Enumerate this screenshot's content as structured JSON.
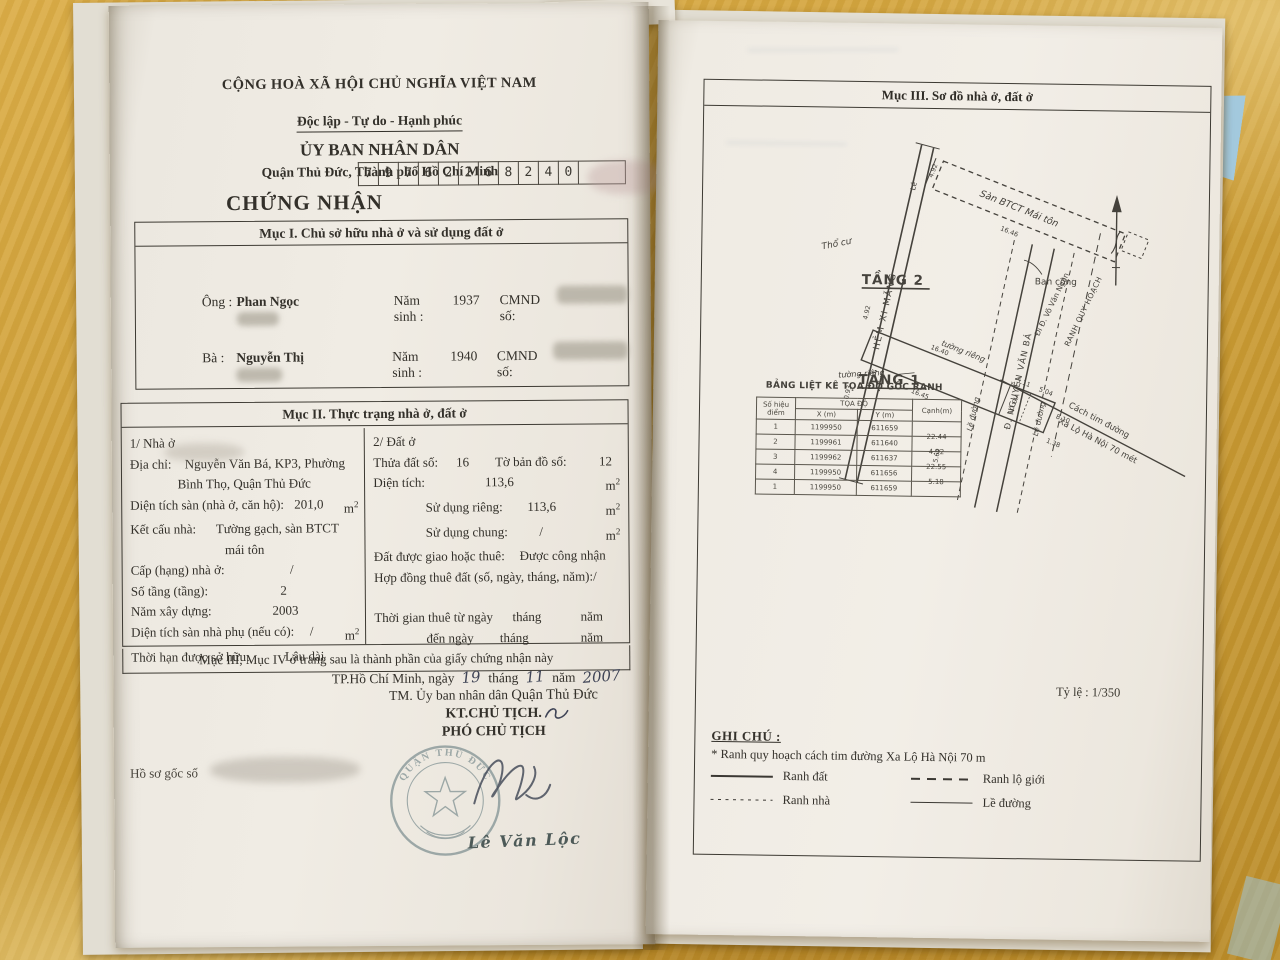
{
  "left_page": {
    "national_header": {
      "line1": "CỘNG HOÀ XÃ HỘI CHỦ NGHĨA VIỆT NAM",
      "line2": "Độc lập - Tự do - Hạnh phúc",
      "line3": "ỦY BAN NHÂN DÂN",
      "line4": "Quận Thủ Đức, Thành phố Hồ Chí Minh"
    },
    "serial_digits": [
      "7",
      "9",
      "7",
      "6",
      "2",
      "2",
      "6",
      "8",
      "2",
      "4",
      "0"
    ],
    "title": "CHỨNG NHẬN",
    "section1": {
      "header": "Mục I. Chủ sở hữu nhà ở và sử dụng đất ở",
      "owner1": {
        "label": "Ông :",
        "name": "Phan Ngọc",
        "birth_label": "Năm sinh :",
        "birth": "1937",
        "id_label": "CMND số:"
      },
      "owner2": {
        "label": "Bà :",
        "name": "Nguyễn Thị",
        "birth_label": "Năm sinh :",
        "birth": "1940",
        "id_label": "CMND số:"
      }
    },
    "section2": {
      "header": "Mục II. Thực trạng nhà ở, đất ở",
      "house": {
        "title": "1/ Nhà ở",
        "addr_label": "Địa chỉ:",
        "addr_value1": "Nguyễn Văn Bá, KP3, Phường",
        "addr_value2": "Bình Thọ, Quận Thủ Đức",
        "floor_label": "Diện tích sàn (nhà ở, căn hộ):",
        "floor_value": "201,0",
        "floor_unit": "m",
        "struct_label": "Kết cấu nhà:",
        "struct_value1": "Tường gạch, sàn BTCT",
        "struct_value2": "mái tôn",
        "grade_label": "Cấp (hạng) nhà ở:",
        "grade_value": "/",
        "storeys_label": "Số tầng (tầng):",
        "storeys_value": "2",
        "year_label": "Năm xây dựng:",
        "year_value": "2003",
        "aux_label": "Diện tích sàn nhà phụ (nếu có):",
        "aux_value": "/",
        "aux_unit": "m",
        "tenure_label": "Thời hạn được sở hữu:",
        "tenure_value": "Lâu dài"
      },
      "land": {
        "title": "2/ Đất ở",
        "plot_label": "Thửa đất số:",
        "plot_value": "16",
        "map_label": "Tờ bản đồ số:",
        "map_value": "12",
        "area_label": "Diện tích:",
        "area_value": "113,6",
        "area_unit": "m",
        "private_label": "Sử dụng riêng:",
        "private_value": "113,6",
        "private_unit": "m",
        "shared_label": "Sử dụng chung:",
        "shared_value": "/",
        "shared_unit": "m",
        "granted_label": "Đất được giao hoặc thuê:",
        "granted_value": "Được công nhận",
        "contract_label": "Hợp đồng thuê đất (số, ngày, tháng, năm):",
        "contract_value": "/",
        "from_label": "Thời gian thuê từ ngày",
        "from_month": "tháng",
        "from_year": "năm",
        "to_label": "đến ngày",
        "to_month": "tháng",
        "to_year": "năm"
      }
    },
    "footer_note": "Mục III, Mục IV ở trang sau là thành phần của giấy chứng nhận này",
    "date_line": {
      "city": "TP.Hồ Chí Minh",
      "ngay": ", ngày",
      "day": "19",
      "thang": "tháng",
      "month": "11",
      "nam": "năm",
      "year": "2007"
    },
    "sign_block": {
      "tm": "TM. Ủy ban nhân dân",
      "district": "Quận Thủ Đức",
      "kt": "KT.CHỦ TỊCH.",
      "pho": "PHÓ CHỦ TỊCH"
    },
    "signer": "Lê Văn Lộc",
    "stamp_arc_top": "QUẬN THỦ ĐỨC",
    "archive_note": "Hồ sơ gốc số"
  },
  "right_page": {
    "header": "Mục III. Sơ đồ nhà ở, đất ở",
    "diagram": {
      "floor2_label": "TẦNG 2",
      "floor1_label": "TẦNG 1",
      "roof_label": "Sàn BTCT Mái tôn",
      "balcony_label": "Ban công",
      "loggia_label": "LÔ GIA",
      "land_label": "Thổ cư",
      "alley_label": "HẺM XI MĂNG",
      "le_label": "Lề",
      "street_di_label": "Đi Đ. Võ Văn Ngân",
      "street_nvb_label": "Đ. NGUYỄN VĂN BÁ",
      "ranh_qh_label": "RANH QUY HOẠCH",
      "distance_label1": "Cách tim đường",
      "distance_label2": "Xa Lộ Hà Nội 70 mét",
      "sidewalk_label": "Lề đường",
      "wall_label": "tường riêng",
      "dims": {
        "d492": "4.92",
        "d1646": "16.46",
        "d1645": "16.45",
        "d1640": "16.40",
        "d511": "5.11",
        "d504": "5.04",
        "d810": "8.10",
        "d138": "1.38",
        "d093": "0.93",
        "d562": "5.62"
      }
    },
    "coord_table": {
      "title": "BẢNG LIỆT KÊ TỌA ĐỘ GỐC RANH",
      "col_point": "Số hiệu điểm",
      "col_coords": "TỌA ĐỘ",
      "col_x": "X (m)",
      "col_y": "Y (m)",
      "col_edge": "Cạnh(m)",
      "rows": [
        {
          "p": "1",
          "x": "1199950",
          "y": "611659",
          "edge": "22.44"
        },
        {
          "p": "2",
          "x": "1199961",
          "y": "611640",
          "edge": "4.92"
        },
        {
          "p": "3",
          "x": "1199962",
          "y": "611637",
          "edge": "22.55"
        },
        {
          "p": "4",
          "x": "1199950",
          "y": "611656",
          "edge": "5.18"
        },
        {
          "p": "1",
          "x": "1199950",
          "y": "611659",
          "edge": ""
        }
      ]
    },
    "scale": {
      "label": "Tỷ lệ :",
      "value": "1/350"
    },
    "legend": {
      "title": "GHI CHÚ :",
      "note": "* Ranh quy hoạch cách tim đường Xa Lộ Hà Nội 70 m",
      "item1": "Ranh đất",
      "item2": "Ranh lộ giới",
      "item3": "Ranh nhà",
      "item4": "Lề đường"
    }
  }
}
